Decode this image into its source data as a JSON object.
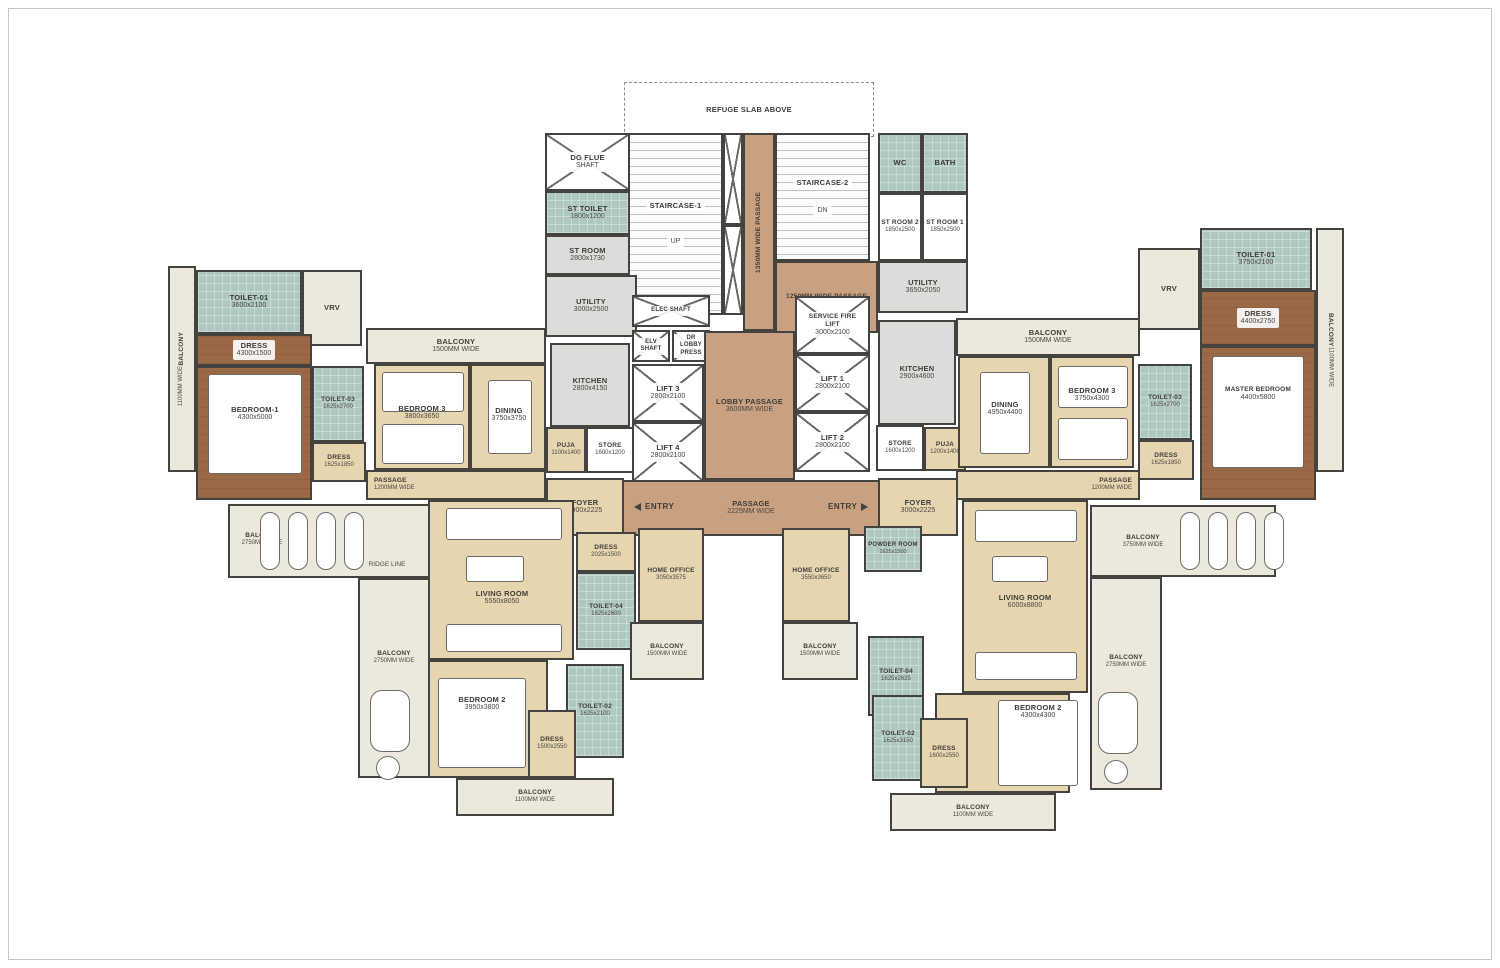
{
  "colors": {
    "wall": "#45433f",
    "marble_floor": "#e6d6b0",
    "balcony_floor": "#ede8dc",
    "passage_floor": "#c9a181",
    "toilet_floor": "#afc9c2",
    "wood_floor": "#9a6a46",
    "service_floor": "#dcdcda"
  },
  "plan": {
    "core": {
      "refuge_slab": {
        "name": "REFUGE SLAB ABOVE"
      },
      "staircase_1": {
        "name": "STAIRCASE-1"
      },
      "staircase_2": {
        "name": "STAIRCASE-2"
      },
      "up": "UP",
      "dn": "DN",
      "dg_flue_shaft": {
        "name": "DG FLUE",
        "dims": "SHAFT"
      },
      "st_toilet": {
        "name": "ST TOILET",
        "dims": "1800x1200"
      },
      "st_room": {
        "name": "ST ROOM",
        "dims": "2800x1730"
      },
      "utility_left": {
        "name": "UTILITY",
        "dims": "3000x2500"
      },
      "passage_1350": {
        "name": "1350MM WIDE PASSAGE"
      },
      "passage_1250": {
        "name": "1250MM WIDE PASSAGE"
      },
      "wc": {
        "name": "WC"
      },
      "bath": {
        "name": "BATH"
      },
      "st_room_2": {
        "name": "ST ROOM 2",
        "dims": "1850x2500"
      },
      "st_room_1": {
        "name": "ST ROOM 1",
        "dims": "1850x2500"
      },
      "utility_right": {
        "name": "UTILITY",
        "dims": "3650x2050"
      },
      "elec_shaft": {
        "name": "ELEC SHAFT"
      },
      "elv_shaft": {
        "name": "ELV SHAFT"
      },
      "dr_lobby": {
        "name": "DR LOBBY PRESS"
      },
      "lift_3": {
        "name": "LIFT 3",
        "dims": "2800x2100"
      },
      "lift_4": {
        "name": "LIFT 4",
        "dims": "2800x2100"
      },
      "service_fire_lift": {
        "name": "SERVICE FIRE LIFT",
        "dims": "3000x2100"
      },
      "lift_1": {
        "name": "LIFT 1",
        "dims": "2800x2100"
      },
      "lift_2": {
        "name": "LIFT 2",
        "dims": "2800x2100"
      },
      "lobby_passage": {
        "name": "LOBBY PASSAGE",
        "dims": "3600MM WIDE"
      },
      "passage_2225": {
        "name": "PASSAGE",
        "dims": "2225MM WIDE"
      },
      "entry": "ENTRY",
      "kitchen_left": {
        "name": "KITCHEN",
        "dims": "2800x4150"
      },
      "store_left": {
        "name": "STORE",
        "dims": "1600x1200"
      },
      "puja_left": {
        "name": "PUJA",
        "dims": "1100x1400"
      },
      "kitchen_right": {
        "name": "KITCHEN",
        "dims": "2900x4600"
      },
      "store_right": {
        "name": "STORE",
        "dims": "1600x1200"
      },
      "puja_right": {
        "name": "PUJA",
        "dims": "1200x1400"
      }
    },
    "unit_a": {
      "balcony_side": {
        "name": "BALCONY",
        "dims": "1100MM WIDE"
      },
      "toilet_01": {
        "name": "TOILET-01",
        "dims": "3600x2100"
      },
      "vrv": {
        "name": "VRV"
      },
      "dress_1": {
        "name": "DRESS",
        "dims": "4300x1500"
      },
      "bedroom_1": {
        "name": "BEDROOM-1",
        "dims": "4300x5000"
      },
      "toilet_03": {
        "name": "TOILET-03",
        "dims": "1625x2700"
      },
      "dress_3": {
        "name": "DRESS",
        "dims": "1625x1850"
      },
      "balcony_top": {
        "name": "BALCONY",
        "dims": "1500MM WIDE"
      },
      "bedroom_3": {
        "name": "BEDROOM 3",
        "dims": "3800x3650"
      },
      "dining": {
        "name": "DINING",
        "dims": "3750x3750"
      },
      "passage": {
        "name": "PASSAGE",
        "dims": "1200MM WIDE"
      },
      "foyer": {
        "name": "FOYER",
        "dims": "2900x2225"
      },
      "living_room": {
        "name": "LIVING ROOM",
        "dims": "5550x8050"
      },
      "dress_4": {
        "name": "DRESS",
        "dims": "2025x1500"
      },
      "toilet_04": {
        "name": "TOILET-04",
        "dims": "1625x2600"
      },
      "home_office": {
        "name": "HOME OFFICE",
        "dims": "3050x3575"
      },
      "balcony_office": {
        "name": "BALCONY",
        "dims": "1500MM WIDE"
      },
      "bedroom_2": {
        "name": "BEDROOM 2",
        "dims": "3950x3800"
      },
      "toilet_02": {
        "name": "TOILET-02",
        "dims": "1625x2100"
      },
      "dress_2": {
        "name": "DRESS",
        "dims": "1500x2550"
      },
      "balcony_bottom": {
        "name": "BALCONY",
        "dims": "1100MM WIDE"
      },
      "balcony_2750_a": {
        "name": "BALCONY",
        "dims": "2750MM WIDE"
      },
      "balcony_2750_b": {
        "name": "BALCONY",
        "dims": "2750MM WIDE"
      },
      "ridge_line": "RIDGE LINE"
    },
    "unit_b": {
      "balcony_top": {
        "name": "BALCONY",
        "dims": "1500MM WIDE"
      },
      "dining": {
        "name": "DINING",
        "dims": "4950x4400"
      },
      "bedroom_3": {
        "name": "BEDROOM 3",
        "dims": "3750x4300"
      },
      "toilet_03": {
        "name": "TOILET-03",
        "dims": "1625x2700"
      },
      "dress_3": {
        "name": "DRESS",
        "dims": "1625x1850"
      },
      "vrv": {
        "name": "VRV"
      },
      "toilet_01": {
        "name": "TOILET-01",
        "dims": "3750x2100"
      },
      "dress_1": {
        "name": "DRESS",
        "dims": "4400x2750"
      },
      "master_bedroom": {
        "name": "MASTER BEDROOM",
        "dims": "4400x5800"
      },
      "balcony_side": {
        "name": "BALCONY",
        "dims": "1100MM WIDE"
      },
      "passage": {
        "name": "PASSAGE",
        "dims": "1200MM WIDE"
      },
      "foyer": {
        "name": "FOYER",
        "dims": "3000x2225"
      },
      "living_room": {
        "name": "LIVING ROOM",
        "dims": "6000x8800"
      },
      "home_office": {
        "name": "HOME OFFICE",
        "dims": "3550x3650"
      },
      "powder_room": {
        "name": "POWDER ROOM",
        "dims": "1625x1500"
      },
      "balcony_office": {
        "name": "BALCONY",
        "dims": "1500MM WIDE"
      },
      "toilet_04": {
        "name": "TOILET-04",
        "dims": "1625x2625"
      },
      "bedroom_2": {
        "name": "BEDROOM 2",
        "dims": "4300x4300"
      },
      "toilet_02": {
        "name": "TOILET-02",
        "dims": "1625x3150"
      },
      "dress_2": {
        "name": "DRESS",
        "dims": "1600x2550"
      },
      "balcony_bottom": {
        "name": "BALCONY",
        "dims": "1100MM WIDE"
      },
      "balcony_3750": {
        "name": "BALCONY",
        "dims": "3750MM WIDE"
      },
      "balcony_2750": {
        "name": "BALCONY",
        "dims": "2750MM WIDE"
      }
    }
  }
}
